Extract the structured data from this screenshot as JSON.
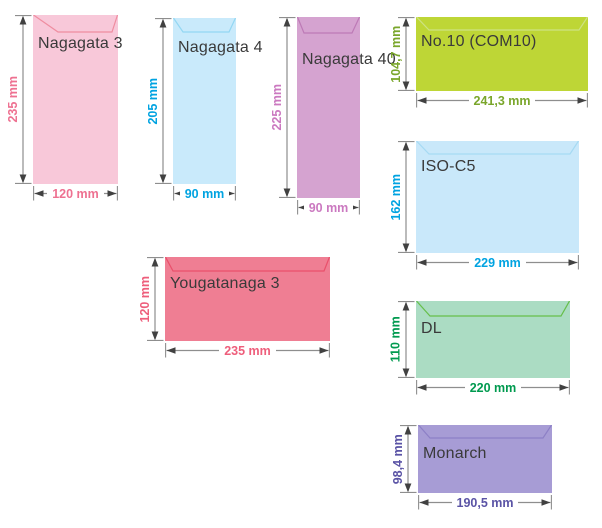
{
  "palette": {
    "background": "#ffffff",
    "label_color": "#3a3a3a",
    "arrow_line_color": "#8e8e8e",
    "arrow_head_color": "#414141",
    "dim_text_background": "#ffffff"
  },
  "units": "mm",
  "envelopes": [
    {
      "id": "nagagata-3",
      "name": "Nagagata 3",
      "orientation": "portrait",
      "height_label": "235 mm",
      "width_label": "120 mm",
      "body_color": "#f8c8d9",
      "flap_outline_color": "#ef8da0",
      "dim_text_color": "#ee7191",
      "geometry": {
        "x": 33,
        "y": 15,
        "w": 85,
        "h": 169,
        "label_top": 21,
        "flap": {
          "left": 25,
          "right": 6,
          "depth": 17
        }
      }
    },
    {
      "id": "nagagata-4",
      "name": "Nagagata 4",
      "orientation": "portrait",
      "height_label": "205 mm",
      "width_label": "90 mm",
      "body_color": "#c9eafb",
      "flap_outline_color": "#93d7f3",
      "dim_text_color": "#00a3e1",
      "geometry": {
        "x": 173,
        "y": 18,
        "w": 63,
        "h": 166,
        "label_top": 22,
        "flap": {
          "left": 10,
          "right": 7,
          "depth": 14
        }
      }
    },
    {
      "id": "nagagata-40",
      "name": "Nagagata 40",
      "orientation": "portrait",
      "height_label": "225 mm",
      "width_label": "90 mm",
      "body_color": "#d5a3d0",
      "flap_outline_color": "#bd7ab6",
      "dim_text_color": "#cb79c0",
      "geometry": {
        "x": 297,
        "y": 17,
        "w": 63,
        "h": 181,
        "label_top": 35,
        "flap": {
          "left": 7,
          "right": 8,
          "depth": 16
        }
      }
    },
    {
      "id": "no10-com10",
      "name": "No.10 (COM10)",
      "orientation": "landscape",
      "height_label": "104,7 mm",
      "width_label": "241,3 mm",
      "body_color": "#bed636",
      "flap_outline_color": "#cde282",
      "dim_text_color": "#7aa62b",
      "geometry": {
        "x": 416,
        "y": 17,
        "w": 172,
        "h": 74,
        "label_top": 17,
        "flap": {
          "left": 13,
          "right": 9,
          "depth": 13
        }
      }
    },
    {
      "id": "iso-c5",
      "name": "ISO-C5",
      "orientation": "landscape",
      "height_label": "162 mm",
      "width_label": "229 mm",
      "body_color": "#c9e8fa",
      "flap_outline_color": "#a6daf3",
      "dim_text_color": "#00a3e1",
      "geometry": {
        "x": 416,
        "y": 141,
        "w": 163,
        "h": 112,
        "label_top": 18,
        "flap": {
          "left": 13,
          "right": 9,
          "depth": 13
        }
      }
    },
    {
      "id": "yougatanaga-3",
      "name": "Yougatanaga 3",
      "orientation": "landscape",
      "height_label": "120 mm",
      "width_label": "235 mm",
      "body_color": "#ef7e93",
      "flap_outline_color": "#e9506b",
      "dim_text_color": "#ee5e7b",
      "geometry": {
        "x": 165,
        "y": 257,
        "w": 165,
        "h": 84,
        "label_top": 19,
        "flap": {
          "left": 8,
          "right": 6,
          "depth": 14
        }
      }
    },
    {
      "id": "dl",
      "name": "DL",
      "orientation": "landscape",
      "height_label": "110 mm",
      "width_label": "220 mm",
      "body_color": "#abdcc3",
      "flap_outline_color": "#66bf4a",
      "dim_text_color": "#009a4f",
      "geometry": {
        "x": 416,
        "y": 301,
        "w": 154,
        "h": 77,
        "label_top": 20,
        "flap": {
          "left": 14,
          "right": 9,
          "depth": 15
        }
      }
    },
    {
      "id": "monarch",
      "name": "Monarch",
      "orientation": "landscape",
      "height_label": "98,4 mm",
      "width_label": "190,5 mm",
      "body_color": "#a79cd5",
      "flap_outline_color": "#8d80c6",
      "dim_text_color": "#5a53a5",
      "geometry": {
        "x": 418,
        "y": 425,
        "w": 134,
        "h": 68,
        "label_top": 21,
        "flap": {
          "left": 12,
          "right": 9,
          "depth": 13
        }
      }
    }
  ]
}
